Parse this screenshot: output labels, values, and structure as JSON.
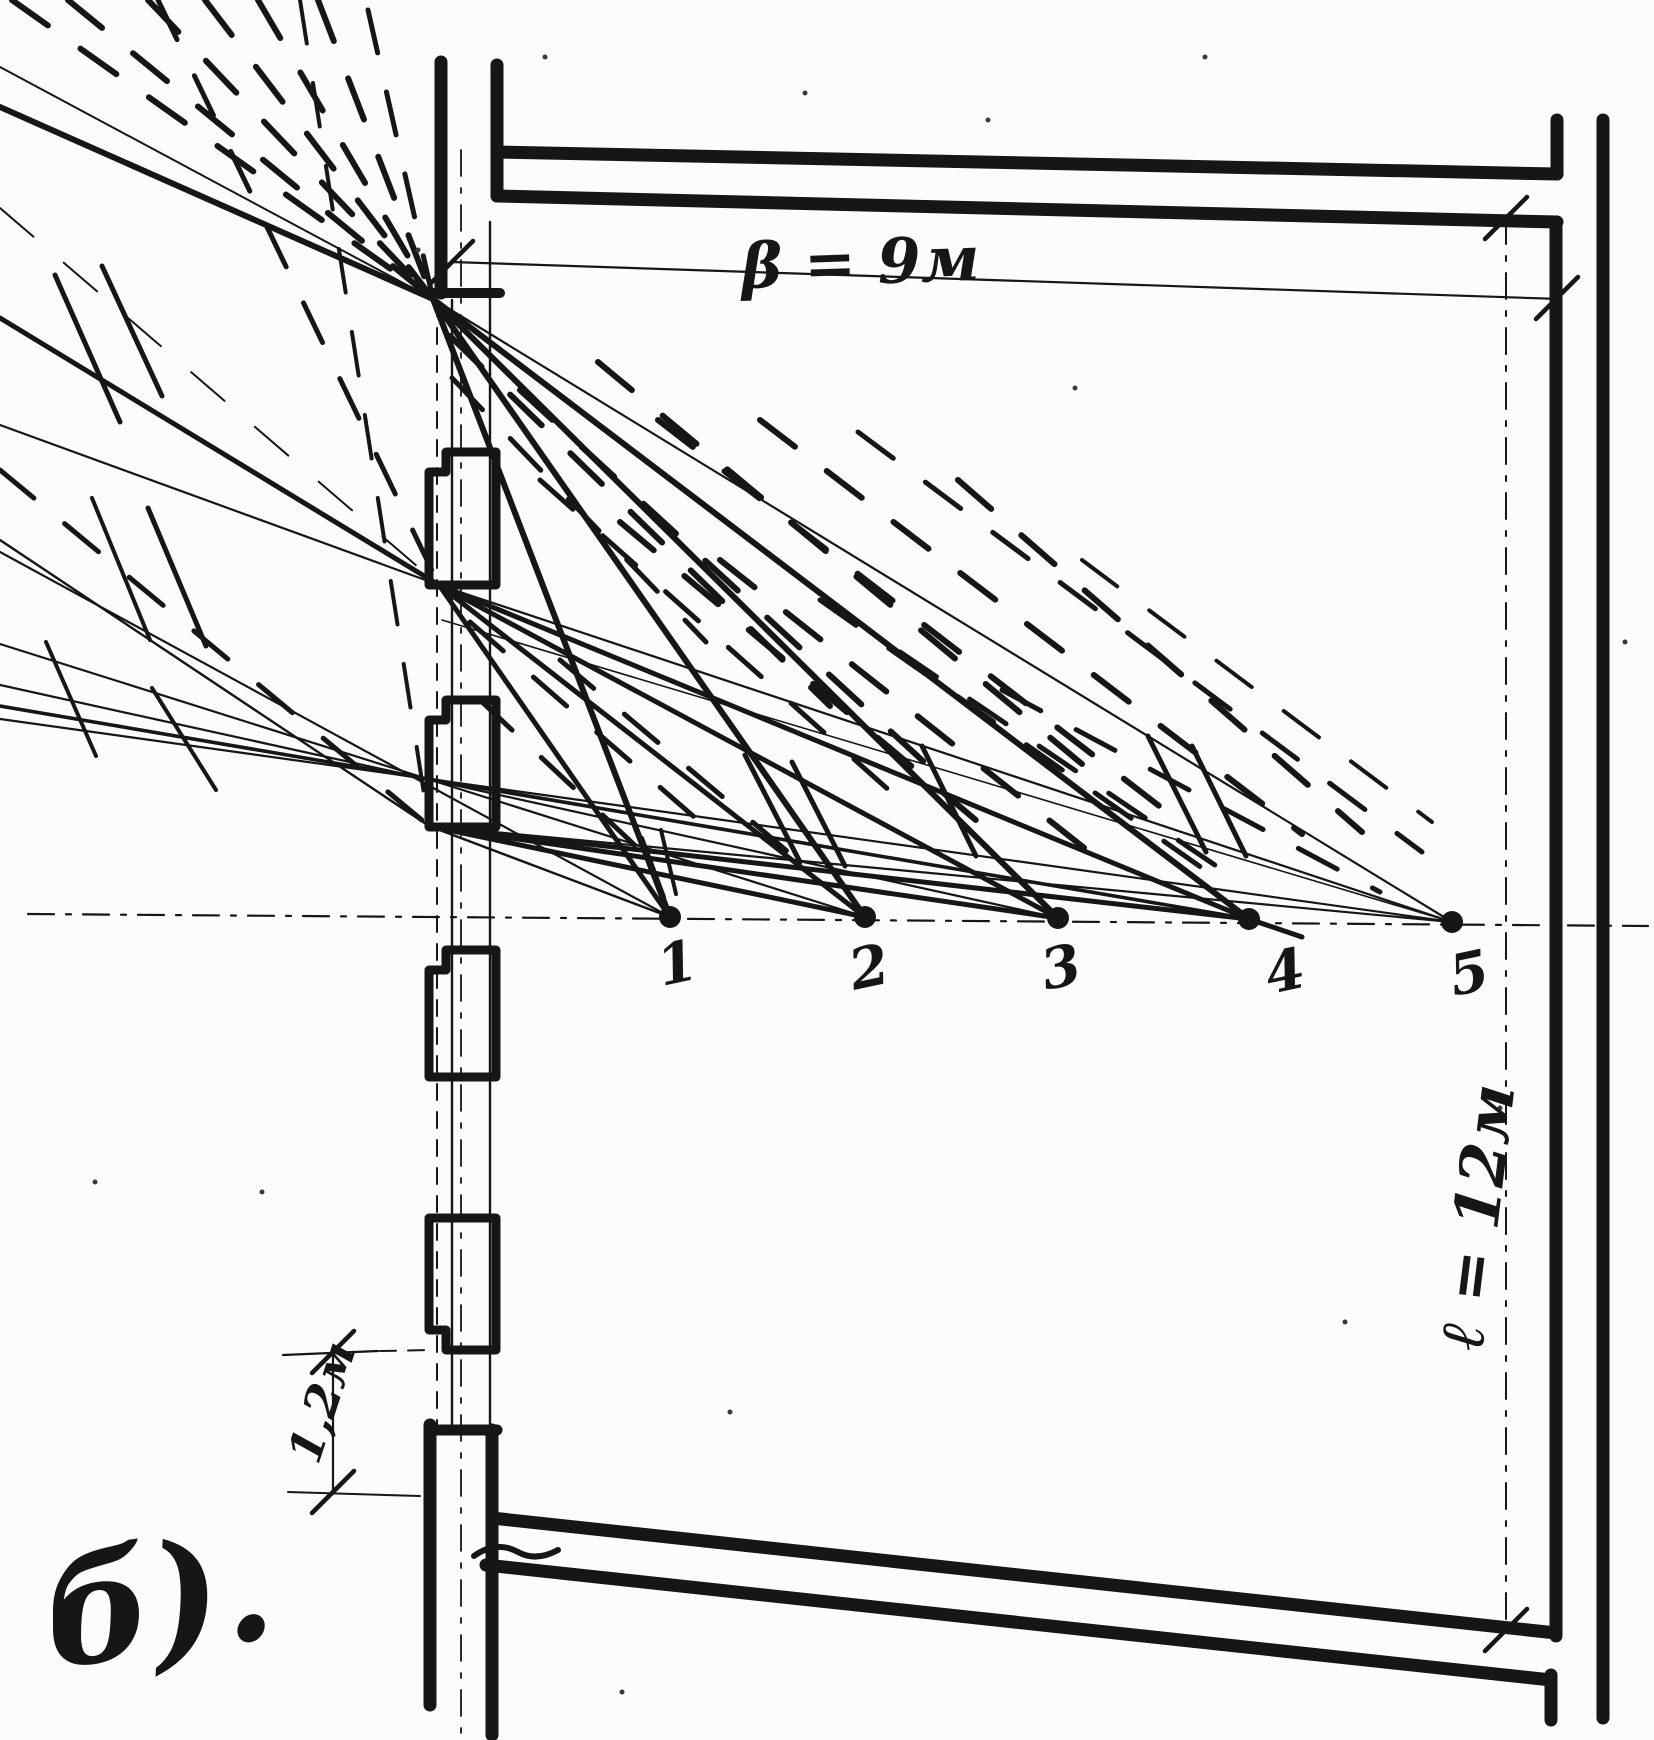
{
  "canvas": {
    "width": 1654,
    "height": 1740,
    "ink": "#161616",
    "paper": "#fcfcfa"
  },
  "figure_label": "б).",
  "dimensions": {
    "beta": {
      "label": "β = 9м",
      "meaning": "room width"
    },
    "depth": {
      "label": "ℓ = 12м",
      "meaning": "room depth"
    },
    "window_spacing": {
      "label": "1,2м",
      "meaning": "window pier spacing"
    }
  },
  "points": [
    {
      "x": 670,
      "y": 917,
      "label": "1"
    },
    {
      "x": 865,
      "y": 917,
      "label": "2"
    },
    {
      "x": 1058,
      "y": 918,
      "label": "3"
    },
    {
      "x": 1249,
      "y": 919,
      "label": "4"
    },
    {
      "x": 1452,
      "y": 922,
      "label": "5"
    }
  ],
  "geometry": {
    "walls": [
      [
        441,
        62,
        441,
        293,
        13
      ],
      [
        429,
        293,
        500,
        293,
        10
      ],
      [
        497,
        65,
        497,
        196,
        13
      ],
      [
        497,
        152,
        1557,
        174,
        13
      ],
      [
        497,
        196,
        1557,
        222,
        13
      ],
      [
        1557,
        120,
        1557,
        174,
        13
      ],
      [
        1603,
        120,
        1603,
        1718,
        13
      ],
      [
        1556,
        222,
        1556,
        1636,
        13
      ],
      [
        492,
        1518,
        1556,
        1633,
        13
      ],
      [
        486,
        1565,
        1551,
        1680,
        13
      ],
      [
        1551,
        1675,
        1551,
        1720,
        13
      ],
      [
        430,
        1425,
        430,
        1705,
        13
      ],
      [
        430,
        1430,
        497,
        1430,
        11
      ],
      [
        492,
        1430,
        492,
        1735,
        13
      ]
    ],
    "thin_solid": [
      [
        452,
        300,
        452,
        1428,
        2.4
      ],
      [
        490,
        222,
        490,
        1430,
        2.4
      ],
      [
        452,
        262,
        1560,
        299,
        2.2
      ],
      [
        333,
        1352,
        333,
        1492,
        2.2
      ],
      [
        283,
        1355,
        378,
        1351,
        2.2
      ],
      [
        288,
        1492,
        420,
        1496,
        2
      ]
    ],
    "thin_dashed": [
      [
        437,
        300,
        437,
        1428,
        2
      ],
      [
        380,
        1351,
        434,
        1350,
        2
      ]
    ],
    "dashdot": [
      [
        28,
        914,
        1648,
        926,
        2.2
      ],
      [
        1506,
        218,
        1506,
        1630,
        2
      ],
      [
        461,
        150,
        461,
        1740,
        1.8
      ]
    ],
    "ticks": [
      [
        452,
        262
      ],
      [
        1557,
        298
      ],
      [
        1506,
        218
      ],
      [
        1506,
        1630
      ],
      [
        333,
        1352
      ],
      [
        333,
        1492
      ]
    ],
    "window_boxes": [
      {
        "x": 429,
        "y": 452,
        "w": 67,
        "h": 133,
        "notch": "tl"
      },
      {
        "x": 429,
        "y": 700,
        "w": 67,
        "h": 127,
        "notch": "tl"
      },
      {
        "x": 429,
        "y": 950,
        "w": 67,
        "h": 127,
        "notch": "tl"
      },
      {
        "x": 429,
        "y": 1218,
        "w": 67,
        "h": 132,
        "notch": "bl"
      }
    ],
    "rays": [
      [
        0,
        67,
        433,
        299,
        2,
        0
      ],
      [
        0,
        107,
        433,
        299,
        6,
        0
      ],
      [
        12,
        0,
        433,
        299,
        6,
        1
      ],
      [
        68,
        0,
        433,
        299,
        6,
        1
      ],
      [
        148,
        0,
        433,
        299,
        6,
        1
      ],
      [
        205,
        0,
        433,
        299,
        6,
        1
      ],
      [
        258,
        0,
        433,
        299,
        6,
        1
      ],
      [
        318,
        0,
        433,
        299,
        6,
        1
      ],
      [
        368,
        10,
        433,
        299,
        5,
        1
      ],
      [
        0,
        318,
        439,
        585,
        5,
        0
      ],
      [
        0,
        425,
        439,
        585,
        2.2,
        0
      ],
      [
        158,
        0,
        439,
        585,
        5,
        1
      ],
      [
        0,
        208,
        439,
        585,
        2,
        1
      ],
      [
        0,
        540,
        429,
        826,
        2.4,
        0
      ],
      [
        0,
        470,
        429,
        826,
        5,
        1
      ],
      [
        300,
        0,
        429,
        826,
        4,
        1
      ],
      [
        433,
        299,
        670,
        917,
        6,
        0
      ],
      [
        433,
        299,
        865,
        917,
        6,
        0
      ],
      [
        433,
        299,
        1058,
        918,
        6,
        0
      ],
      [
        433,
        299,
        1249,
        919,
        6,
        0
      ],
      [
        433,
        299,
        1452,
        922,
        2.2,
        0
      ],
      [
        439,
        585,
        670,
        917,
        5,
        0
      ],
      [
        439,
        585,
        865,
        917,
        5,
        0
      ],
      [
        439,
        585,
        1058,
        918,
        5,
        0
      ],
      [
        439,
        585,
        1249,
        919,
        5,
        0
      ],
      [
        439,
        585,
        1452,
        922,
        2.2,
        0
      ],
      [
        429,
        826,
        670,
        917,
        2.4,
        0
      ],
      [
        429,
        826,
        865,
        917,
        5,
        0
      ],
      [
        429,
        826,
        1058,
        918,
        5,
        0
      ],
      [
        429,
        826,
        1249,
        919,
        5,
        0
      ],
      [
        429,
        826,
        1452,
        922,
        2.2,
        0
      ],
      [
        442,
        620,
        1452,
        922,
        1.6,
        0
      ],
      [
        0,
        552,
        670,
        917,
        2.2,
        0
      ],
      [
        0,
        644,
        865,
        917,
        2.2,
        0
      ],
      [
        0,
        685,
        1058,
        918,
        2.2,
        0
      ],
      [
        0,
        706,
        1249,
        919,
        3.6,
        0
      ],
      [
        0,
        719,
        1452,
        922,
        2.2,
        0
      ],
      [
        1249,
        919,
        1302,
        937,
        5,
        0
      ],
      [
        450,
        336,
        830,
        706,
        6,
        1
      ],
      [
        452,
        378,
        706,
        642,
        5,
        1
      ],
      [
        520,
        390,
        924,
        762,
        6,
        1
      ],
      [
        598,
        362,
        1082,
        764,
        6,
        1
      ],
      [
        658,
        420,
        1180,
        822,
        6,
        1
      ],
      [
        760,
        420,
        1302,
        834,
        6,
        1
      ],
      [
        858,
        432,
        1422,
        852,
        5,
        1
      ],
      [
        958,
        480,
        1362,
        832,
        6,
        1
      ],
      [
        540,
        480,
        900,
        800,
        5,
        1
      ],
      [
        620,
        522,
        1002,
        842,
        6,
        1
      ],
      [
        720,
        560,
        1102,
        862,
        6,
        1
      ],
      [
        820,
        600,
        1222,
        882,
        5,
        1
      ],
      [
        470,
        622,
        700,
        822,
        5,
        1
      ],
      [
        560,
        660,
        800,
        862,
        5,
        1
      ],
      [
        900,
        652,
        1240,
        882,
        5,
        1
      ],
      [
        1002,
        690,
        1380,
        892,
        5,
        1
      ],
      [
        1082,
        560,
        1432,
        822,
        4,
        1
      ],
      [
        480,
        700,
        642,
        852,
        5,
        1
      ],
      [
        745,
        755,
        800,
        862,
        5,
        0
      ],
      [
        792,
        762,
        845,
        866,
        5,
        0
      ],
      [
        922,
        746,
        976,
        856,
        5,
        0
      ],
      [
        1148,
        736,
        1206,
        852,
        5,
        0
      ],
      [
        1192,
        746,
        1246,
        856,
        5,
        0
      ],
      [
        642,
        838,
        664,
        897,
        4,
        0
      ],
      [
        661,
        830,
        676,
        894,
        4,
        0
      ],
      [
        55,
        275,
        120,
        422,
        5,
        0
      ],
      [
        102,
        266,
        162,
        396,
        5,
        0
      ],
      [
        148,
        508,
        206,
        646,
        5,
        0
      ],
      [
        92,
        498,
        150,
        640,
        4,
        0
      ],
      [
        46,
        642,
        96,
        756,
        4,
        0
      ],
      [
        152,
        688,
        216,
        790,
        4,
        0
      ]
    ],
    "squiggle": "M474,1556 q22,-16 44,-4 q18,10 40,-2",
    "specks": [
      [
        805,
        93
      ],
      [
        1075,
        388
      ],
      [
        988,
        120
      ],
      [
        262,
        1192
      ],
      [
        622,
        1692
      ],
      [
        1345,
        1322
      ],
      [
        95,
        1182
      ],
      [
        1500,
        1108
      ],
      [
        730,
        1412
      ],
      [
        1625,
        642
      ],
      [
        545,
        57
      ],
      [
        1205,
        57
      ],
      [
        418,
        250
      ]
    ]
  }
}
